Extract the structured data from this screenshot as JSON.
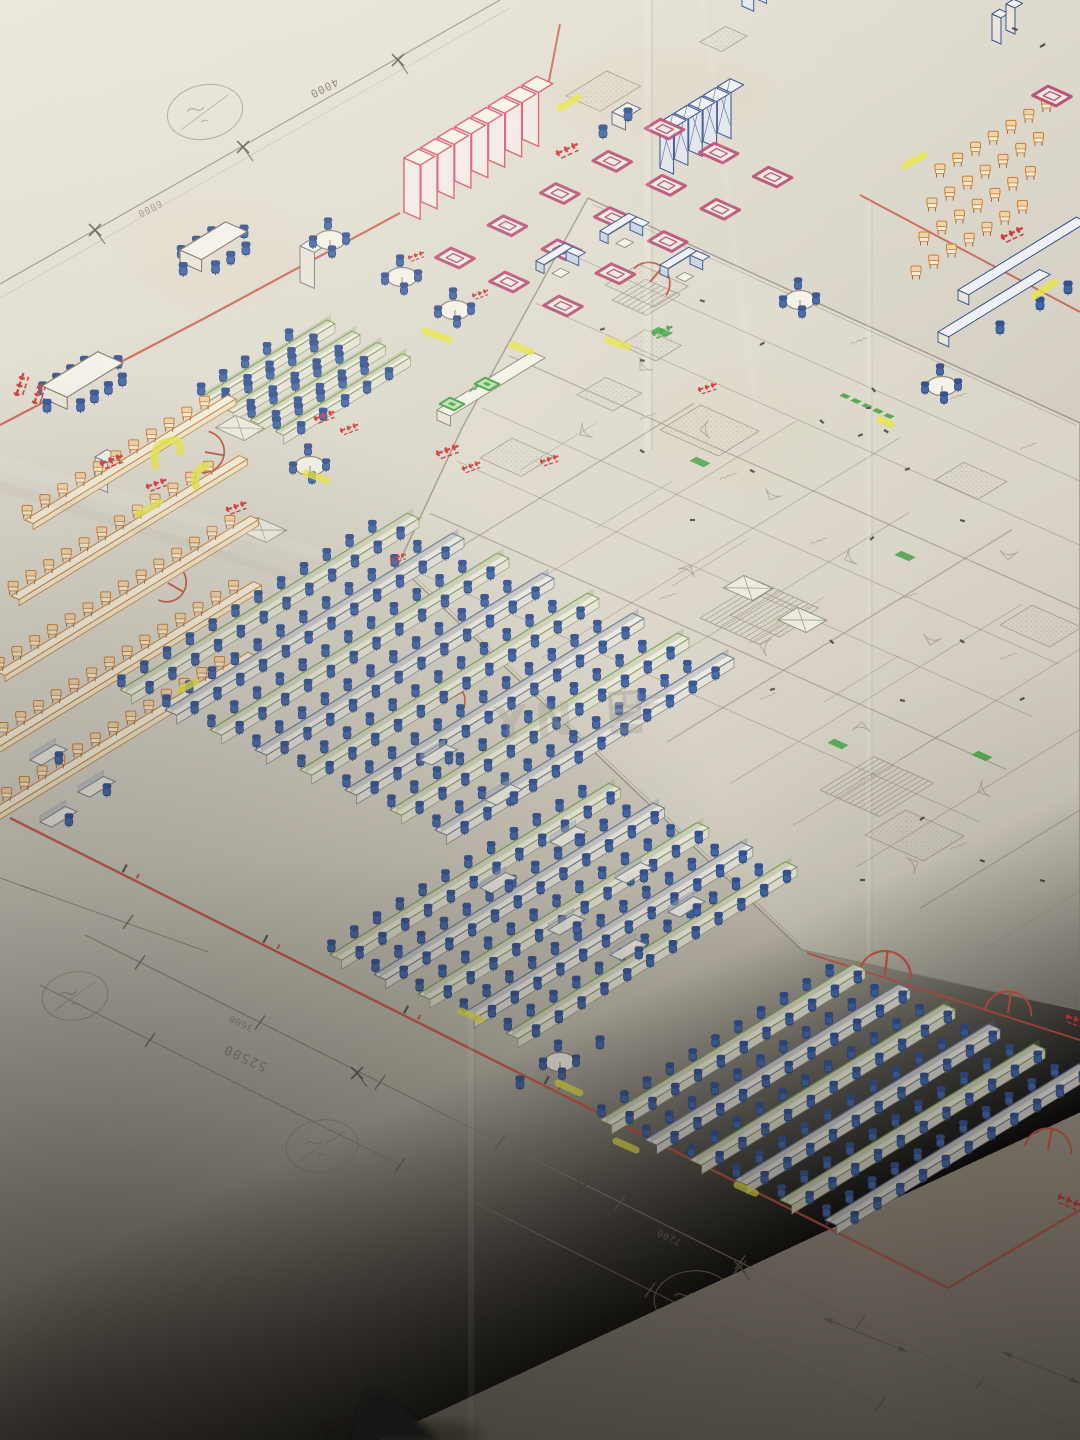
{
  "photo": {
    "watermark_letters": "YN"
  },
  "dimension_labels": {
    "top_a": "4000",
    "top_b": "6000",
    "bottom_total": "52500",
    "bottom_a": "3600",
    "bottom_b": "7200"
  },
  "palette": {
    "paper": "#dad5c9",
    "pencil": "#8d8779",
    "boundary_red": "#c4503f",
    "stamp_red": "#cc3636",
    "furniture_red": "#d9556a",
    "magenta": "#b5446e",
    "navy": "#33508c",
    "chair_blue": "#3c62a8",
    "desk_green": "#7d9a58",
    "marker_green": "#3fa03f",
    "orange": "#c87a2e",
    "seat_tan": "#ecd2a8",
    "highlight_yellow": "#e9e63e",
    "desk_white": "#f0ece1"
  }
}
